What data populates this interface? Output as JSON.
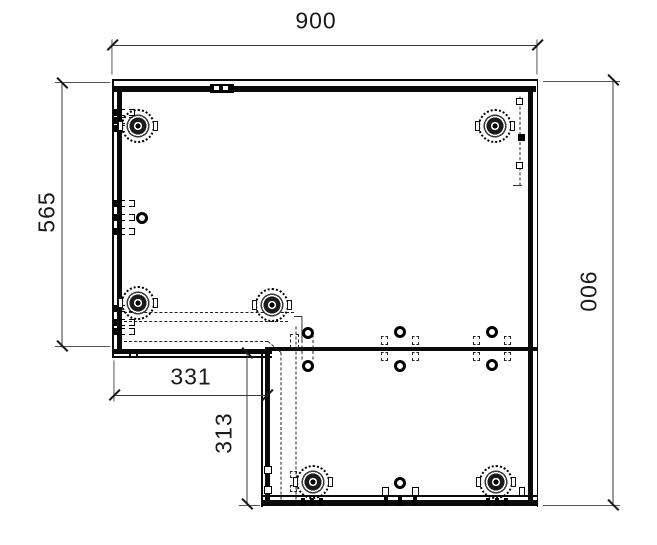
{
  "meta": {
    "drawing_type": "furniture corner panel plan",
    "canvas": {
      "width": 657,
      "height": 545
    },
    "colors": {
      "background": "#ffffff",
      "edge": "#0a0a0a",
      "dimension": "#3a3a3a",
      "hidden": "#222222",
      "text": "#1a1a1a"
    }
  },
  "dimensions": [
    {
      "name": "overall-width",
      "label": "900",
      "text": {
        "x": 316,
        "y": 21,
        "rotate": 0
      },
      "line": {
        "x1": 112,
        "y1": 45,
        "x2": 538,
        "y2": 45
      },
      "ticks": [
        {
          "x": 112,
          "y": 45,
          "dir": "slash"
        },
        {
          "x": 537,
          "y": 45,
          "dir": "slash"
        }
      ],
      "ext": [
        {
          "x1": 112,
          "y1": 39,
          "x2": 112,
          "y2": 74
        },
        {
          "x1": 537,
          "y1": 39,
          "x2": 537,
          "y2": 74
        }
      ]
    },
    {
      "name": "overall-height",
      "label": "900",
      "text": {
        "x": 588,
        "y": 292,
        "rotate": 90
      },
      "line": {
        "x1": 613,
        "y1": 79,
        "x2": 613,
        "y2": 506
      },
      "ticks": [
        {
          "x": 613,
          "y": 80,
          "dir": "back"
        },
        {
          "x": 613,
          "y": 505,
          "dir": "back"
        }
      ],
      "ext": [
        {
          "x1": 543,
          "y1": 81,
          "x2": 620,
          "y2": 81
        },
        {
          "x1": 543,
          "y1": 505,
          "x2": 620,
          "y2": 505
        }
      ]
    },
    {
      "name": "left-depth",
      "label": "565",
      "text": {
        "x": 47,
        "y": 212,
        "rotate": -90
      },
      "line": {
        "x1": 62,
        "y1": 82,
        "x2": 62,
        "y2": 347
      },
      "ticks": [
        {
          "x": 62,
          "y": 83,
          "dir": "back"
        },
        {
          "x": 62,
          "y": 346,
          "dir": "back"
        }
      ],
      "ext": [
        {
          "x1": 55,
          "y1": 82,
          "x2": 110,
          "y2": 82
        },
        {
          "x1": 55,
          "y1": 346,
          "x2": 110,
          "y2": 346
        }
      ]
    },
    {
      "name": "notch-width",
      "label": "331",
      "text": {
        "x": 191,
        "y": 377,
        "rotate": 0
      },
      "line": {
        "x1": 114,
        "y1": 395,
        "x2": 267,
        "y2": 395
      },
      "ticks": [
        {
          "x": 114,
          "y": 395,
          "dir": "slash"
        },
        {
          "x": 267,
          "y": 395,
          "dir": "slash"
        }
      ],
      "ext": [
        {
          "x1": 114,
          "y1": 360,
          "x2": 114,
          "y2": 401
        }
      ]
    },
    {
      "name": "notch-height",
      "label": "313",
      "text": {
        "x": 224,
        "y": 433,
        "rotate": -90
      },
      "line": {
        "x1": 247,
        "y1": 352,
        "x2": 247,
        "y2": 505
      },
      "ticks": [
        {
          "x": 247,
          "y": 353,
          "dir": "back"
        },
        {
          "x": 247,
          "y": 504,
          "dir": "back"
        }
      ],
      "ext": [
        {
          "x1": 239,
          "y1": 505,
          "x2": 260,
          "y2": 505
        }
      ]
    }
  ],
  "panel_edges": [
    {
      "x": 112,
      "y": 79,
      "w": 426,
      "h": 1.5
    },
    {
      "x": 112,
      "y": 86,
      "w": 424,
      "h": 6
    },
    {
      "x": 112,
      "y": 79,
      "w": 1.5,
      "h": 278
    },
    {
      "x": 117,
      "y": 86,
      "w": 5,
      "h": 266
    },
    {
      "x": 536.5,
      "y": 79,
      "w": 1.5,
      "h": 428
    },
    {
      "x": 528,
      "y": 86,
      "w": 5,
      "h": 417
    },
    {
      "x": 261,
      "y": 495,
      "w": 276,
      "h": 1.5
    },
    {
      "x": 261,
      "y": 500,
      "w": 276,
      "h": 6
    },
    {
      "x": 112,
      "y": 349,
      "w": 160,
      "h": 5
    },
    {
      "x": 112,
      "y": 356,
      "w": 160,
      "h": 1.5
    },
    {
      "x": 129,
      "y": 349,
      "w": 1.5,
      "h": 8
    },
    {
      "x": 136,
      "y": 349,
      "w": 1.5,
      "h": 8
    },
    {
      "x": 261,
      "y": 352,
      "w": 1.5,
      "h": 155
    },
    {
      "x": 265,
      "y": 352,
      "w": 5,
      "h": 150
    },
    {
      "x": 265,
      "y": 347,
      "w": 272,
      "h": 3.5
    }
  ],
  "hidden_lines": [
    {
      "x1": 124,
      "y1": 313,
      "x2": 294,
      "y2": 313
    },
    {
      "x1": 124,
      "y1": 322,
      "x2": 288,
      "y2": 322
    },
    {
      "x1": 124,
      "y1": 342,
      "x2": 268,
      "y2": 342
    },
    {
      "x1": 268,
      "y1": 342,
      "x2": 281,
      "y2": 353
    },
    {
      "x1": 281,
      "y1": 353,
      "x2": 281,
      "y2": 500
    },
    {
      "x1": 296,
      "y1": 327,
      "x2": 296,
      "y2": 500
    },
    {
      "x1": 520,
      "y1": 97,
      "x2": 520,
      "y2": 186
    },
    {
      "x1": 302,
      "y1": 335,
      "x2": 302,
      "y2": 360
    },
    {
      "x1": 313,
      "y1": 335,
      "x2": 313,
      "y2": 360
    }
  ],
  "hidden_rects": [
    {
      "x": 290,
      "y": 334,
      "w": 9,
      "h": 14
    },
    {
      "x": 290,
      "y": 471,
      "w": 7,
      "h": 7
    },
    {
      "x": 290,
      "y": 485,
      "w": 7,
      "h": 7
    },
    {
      "x": 381,
      "y": 336,
      "w": 7,
      "h": 9
    },
    {
      "x": 412,
      "y": 336,
      "w": 7,
      "h": 9
    },
    {
      "x": 381,
      "y": 352,
      "w": 7,
      "h": 9
    },
    {
      "x": 412,
      "y": 352,
      "w": 7,
      "h": 9
    },
    {
      "x": 473,
      "y": 336,
      "w": 7,
      "h": 9
    },
    {
      "x": 504,
      "y": 336,
      "w": 7,
      "h": 9
    },
    {
      "x": 473,
      "y": 352,
      "w": 7,
      "h": 9
    },
    {
      "x": 504,
      "y": 352,
      "w": 7,
      "h": 9
    }
  ],
  "solid_thin_lines": [
    {
      "x1": 294,
      "y1": 316,
      "x2": 302,
      "y2": 316
    },
    {
      "x1": 302,
      "y1": 316,
      "x2": 302,
      "y2": 340
    },
    {
      "x1": 513,
      "y1": 185,
      "x2": 522,
      "y2": 185
    }
  ],
  "cam_fittings": [
    {
      "x": 138,
      "y": 126
    },
    {
      "x": 495,
      "y": 126
    },
    {
      "x": 138,
      "y": 303
    },
    {
      "x": 272,
      "y": 305
    },
    {
      "x": 313,
      "y": 482
    },
    {
      "x": 496,
      "y": 482
    }
  ],
  "holes": [
    {
      "x": 142,
      "y": 218
    },
    {
      "x": 308,
      "y": 333
    },
    {
      "x": 308,
      "y": 366
    },
    {
      "x": 400,
      "y": 332
    },
    {
      "x": 400,
      "y": 366
    },
    {
      "x": 492,
      "y": 332
    },
    {
      "x": 492,
      "y": 365
    },
    {
      "x": 400,
      "y": 483
    }
  ],
  "bracket_rows": [
    {
      "x": 113,
      "y": 112
    },
    {
      "x": 113,
      "y": 120
    },
    {
      "x": 113,
      "y": 128
    },
    {
      "x": 113,
      "y": 203
    },
    {
      "x": 113,
      "y": 217
    },
    {
      "x": 113,
      "y": 231
    },
    {
      "x": 113,
      "y": 308
    },
    {
      "x": 113,
      "y": 322
    },
    {
      "x": 113,
      "y": 331
    }
  ],
  "squares": [
    {
      "x": 264,
      "y": 466,
      "w": 8,
      "h": 8
    },
    {
      "x": 264,
      "y": 486,
      "w": 8,
      "h": 8
    },
    {
      "x": 516,
      "y": 98,
      "w": 7,
      "h": 7
    },
    {
      "x": 516,
      "y": 162,
      "w": 7,
      "h": 7
    }
  ],
  "filled_squares": [
    {
      "x": 518,
      "y": 134,
      "w": 7,
      "h": 7
    }
  ],
  "pi_brackets": [
    {
      "x": 382,
      "y": 487,
      "w": 7,
      "h": 8
    },
    {
      "x": 412,
      "y": 487,
      "w": 7,
      "h": 8
    },
    {
      "x": 519,
      "y": 487,
      "w": 6,
      "h": 8
    }
  ],
  "nubs": [
    {
      "x": 301,
      "y": 498,
      "w": 4,
      "h": 7
    },
    {
      "x": 310,
      "y": 498,
      "w": 4,
      "h": 7
    },
    {
      "x": 319,
      "y": 498,
      "w": 4,
      "h": 7
    },
    {
      "x": 384,
      "y": 497,
      "w": 4,
      "h": 8
    },
    {
      "x": 398,
      "y": 497,
      "w": 4,
      "h": 8
    },
    {
      "x": 413,
      "y": 497,
      "w": 4,
      "h": 8
    },
    {
      "x": 486,
      "y": 498,
      "w": 4,
      "h": 7
    },
    {
      "x": 495,
      "y": 498,
      "w": 4,
      "h": 7
    },
    {
      "x": 504,
      "y": 498,
      "w": 4,
      "h": 7
    }
  ],
  "top_connector": {
    "x": 210,
    "y": 84,
    "w": 24,
    "h": 9,
    "holes": [
      {
        "x": 4,
        "y": 2,
        "w": 5,
        "h": 4
      },
      {
        "x": 13,
        "y": 2,
        "w": 5,
        "h": 4
      }
    ]
  }
}
